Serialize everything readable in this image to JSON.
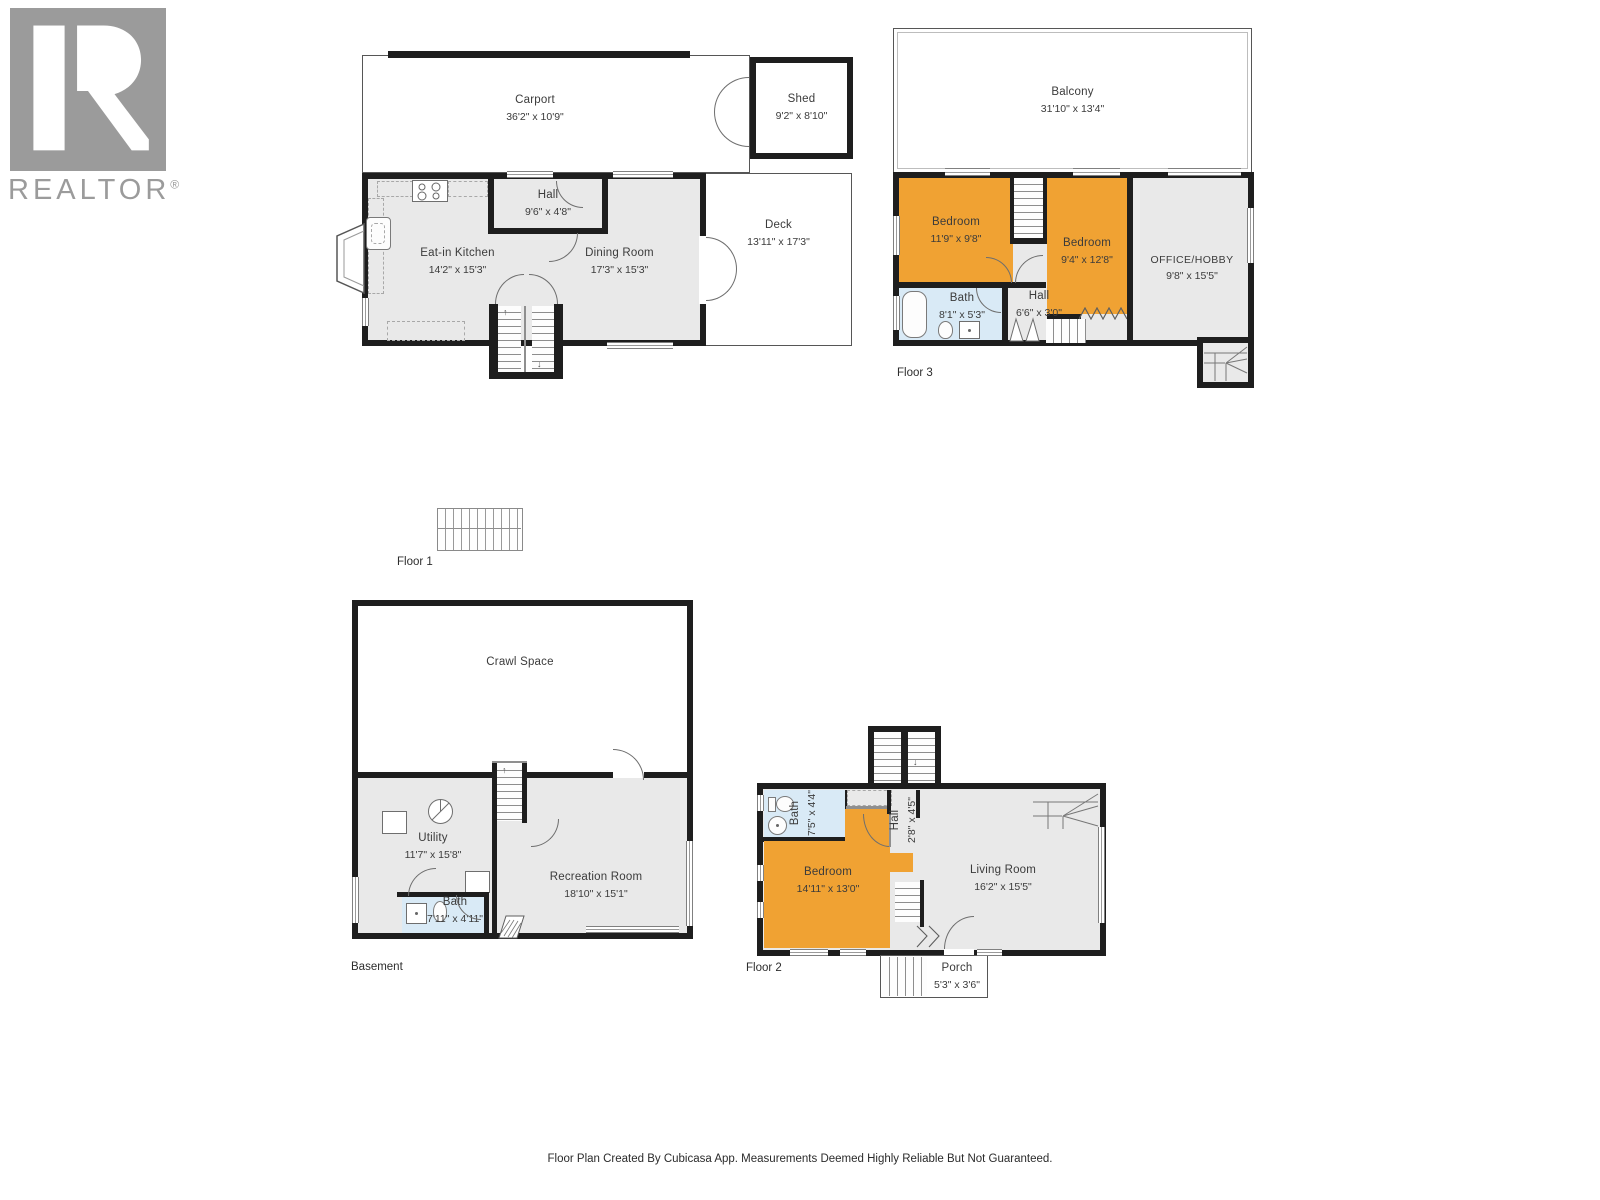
{
  "logo": {
    "text": "REALTOR",
    "registered": "®"
  },
  "colors": {
    "wall": "#1e1e1e",
    "room_gray": "#e9e9e9",
    "highlight_orange": "#f0a233",
    "bath_blue": "#d9eaf6",
    "logo_gray": "#9b9b9b",
    "label_text": "#3b3b3b"
  },
  "floors": {
    "floor1": {
      "label": "Floor 1",
      "carport": {
        "name": "Carport",
        "dims": "36'2\" x 10'9\""
      },
      "shed": {
        "name": "Shed",
        "dims": "9'2\" x 8'10\""
      },
      "hall": {
        "name": "Hall",
        "dims": "9'6\" x 4'8\""
      },
      "kitchen": {
        "name": "Eat-in Kitchen",
        "dims": "14'2\" x 15'3\""
      },
      "dining": {
        "name": "Dining Room",
        "dims": "17'3\" x 15'3\""
      },
      "deck": {
        "name": "Deck",
        "dims": "13'11\" x 17'3\""
      }
    },
    "floor3": {
      "label": "Floor 3",
      "balcony": {
        "name": "Balcony",
        "dims": "31'10\" x 13'4\""
      },
      "bedroom1": {
        "name": "Bedroom",
        "dims": "11'9\" x 9'8\""
      },
      "bedroom2": {
        "name": "Bedroom",
        "dims": "9'4\" x 12'8\""
      },
      "office": {
        "name": "OFFICE/HOBBY",
        "dims": "9'8\" x 15'5\""
      },
      "bath": {
        "name": "Bath",
        "dims": "8'1\" x 5'3\""
      },
      "hall": {
        "name": "Hall",
        "dims": "6'6\" x 3'0\""
      }
    },
    "basement": {
      "label": "Basement",
      "crawl": {
        "name": "Crawl Space"
      },
      "utility": {
        "name": "Utility",
        "dims": "11'7\" x 15'8\""
      },
      "rec": {
        "name": "Recreation Room",
        "dims": "18'10\" x 15'1\""
      },
      "bath": {
        "name": "Bath",
        "dims": "7'11\" x 4'11\""
      }
    },
    "floor2": {
      "label": "Floor 2",
      "bath": {
        "name": "Bath",
        "dims": "7'5\" x 4'4\""
      },
      "bedroom": {
        "name": "Bedroom",
        "dims": "14'11\" x 13'0\""
      },
      "hall": {
        "name": "Hall",
        "dims": "2'8\" x 4'5\""
      },
      "living": {
        "name": "Living Room",
        "dims": "16'2\" x 15'5\""
      },
      "porch": {
        "name": "Porch",
        "dims": "5'3\" x 3'6\""
      }
    }
  },
  "footer": {
    "disclaimer": "Floor Plan Created By Cubicasa App. Measurements Deemed Highly Reliable But Not Guaranteed."
  }
}
